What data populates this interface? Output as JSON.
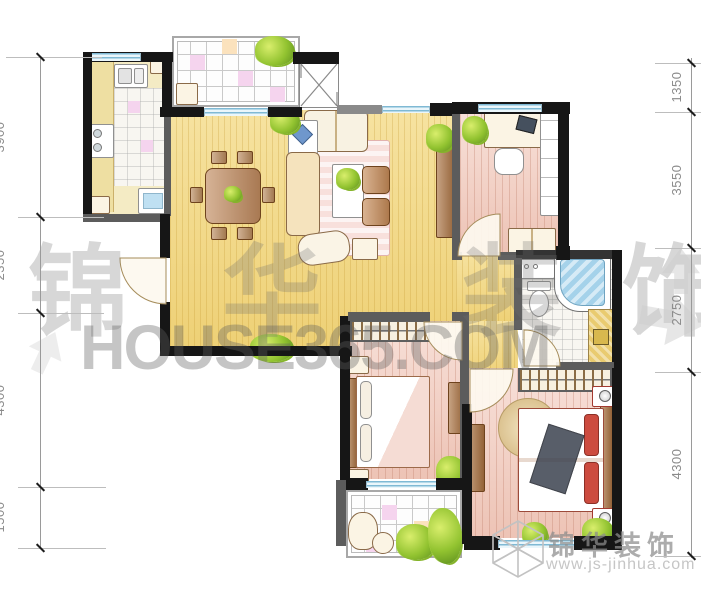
{
  "watermarks": {
    "brand_char_1": "锦",
    "brand_char_2": "华",
    "brand_char_3": "装",
    "brand_char_4": "饰",
    "site": "HOUSE365.COM",
    "footer_brand": "锦华装饰",
    "footer_url": "www.js-jinhua.com"
  },
  "dimensions": {
    "right": [
      {
        "label": "1350"
      },
      {
        "label": "3550"
      },
      {
        "label": "2750"
      },
      {
        "label": "4300"
      }
    ],
    "left": [
      {
        "label": "3900"
      },
      {
        "label": "2350"
      },
      {
        "label": "4300"
      },
      {
        "label": "1500"
      }
    ]
  },
  "colors": {
    "living_floor": "#f3d981",
    "bedroom_floor": "#f4d2c7",
    "wall_exterior": "#161616",
    "wall_interior": "#5c5c5c",
    "window_blue": "#7fb9d4",
    "tub_blue": "#a5d2ea",
    "plant_green": "#92c330",
    "wood_brown": "#a8703f",
    "watermark_gray": "#9a9a9a"
  }
}
